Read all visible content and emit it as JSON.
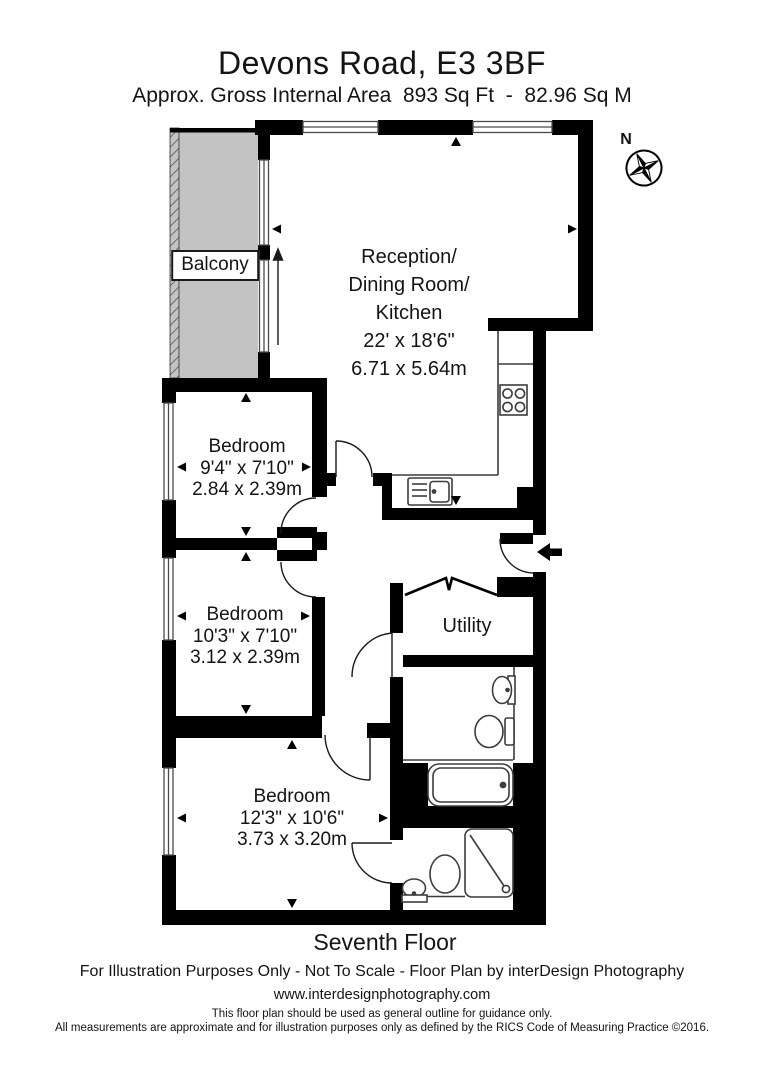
{
  "header": {
    "title": "Devons Road, E3 3BF",
    "subtitle": "Approx. Gross Internal Area  893 Sq Ft  -  82.96 Sq M"
  },
  "compass": {
    "label": "N"
  },
  "rooms": {
    "reception": {
      "lines": [
        "Reception/",
        "Dining Room/",
        "Kitchen"
      ],
      "imperial": "22' x 18'6\"",
      "metric": "6.71 x 5.64m"
    },
    "bedroom1": {
      "name": "Bedroom",
      "imperial": "9'4\" x 7'10\"",
      "metric": "2.84 x 2.39m"
    },
    "bedroom2": {
      "name": "Bedroom",
      "imperial": "10'3\" x 7'10\"",
      "metric": "3.12 x 2.39m"
    },
    "bedroom3": {
      "name": "Bedroom",
      "imperial": "12'3\" x 10'6\"",
      "metric": "3.73 x 3.20m"
    },
    "utility": {
      "name": "Utility"
    },
    "balcony": {
      "name": "Balcony"
    }
  },
  "floor_label": "Seventh Floor",
  "footer": {
    "line1": "For Illustration Purposes Only - Not To Scale - Floor Plan by interDesign Photography",
    "line2": "www.interdesignphotography.com",
    "line3": "This floor plan should be used as general outline for guidance only.",
    "line4": "All measurements are approximate and for illustration purposes only as defined by the RICS Code of Measuring Practice ©2016."
  },
  "colors": {
    "wall": "#000000",
    "balcony_fill": "#c3c3c3",
    "fixture_line": "#3c3c3c"
  }
}
